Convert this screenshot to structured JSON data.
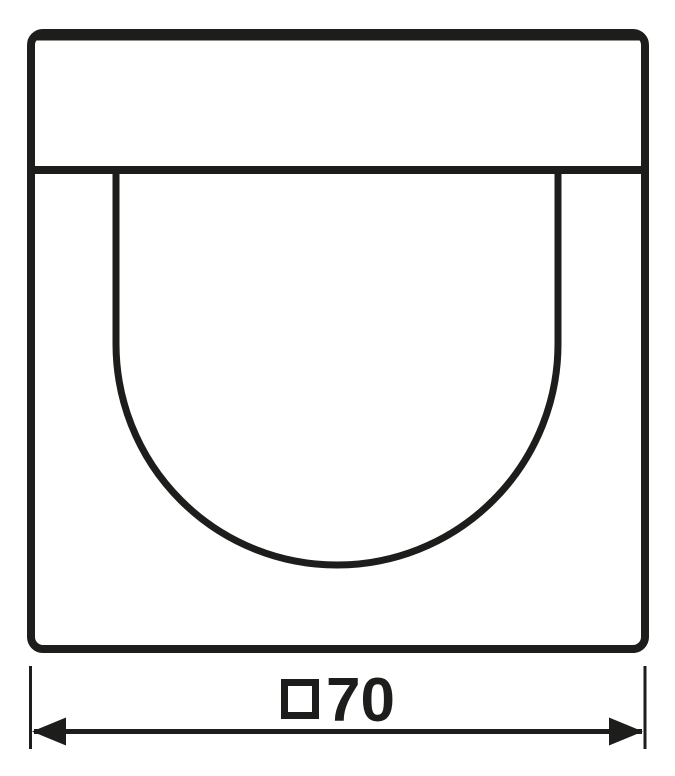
{
  "window": {
    "background_color": "#ffffff"
  },
  "drawing": {
    "line_color": "#1d1d1b",
    "subject": "cover-plate-front-view",
    "parts": {
      "frame": "outer rounded square outline",
      "divider": "full-width horizontal line in upper area",
      "arch": "u-shaped detector window outline"
    }
  },
  "dimension": {
    "value": "70",
    "symbol": "square",
    "full_label": "□70"
  }
}
